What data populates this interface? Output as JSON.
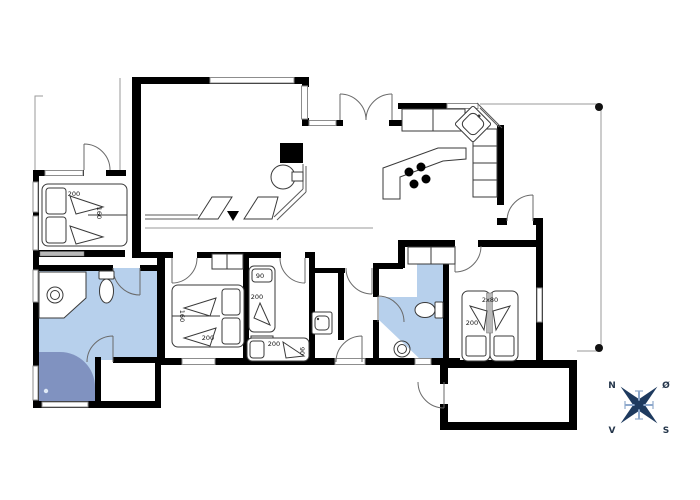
{
  "colors": {
    "wall": "#000000",
    "window_glass": "#8d8d8d",
    "bathroom_floor": "#b7d0ec",
    "shower_floor": "#8092c0",
    "compass_star": "#1e3a5f",
    "compass_cross": "#8fa9cc",
    "terrace_outline": "#9a9a9a"
  },
  "beds": {
    "bedroom_nw": {
      "length": "200",
      "width": "160"
    },
    "bedroom_mid": {
      "width": "160",
      "length": "200"
    },
    "kids_bed_vertical": {
      "width": "90",
      "length": "200"
    },
    "kids_bed_horizontal": {
      "length": "200",
      "width": "90"
    },
    "bedroom_se": {
      "size": "2x80",
      "length": "200"
    }
  },
  "compass": {
    "north": "N",
    "east": "Ø",
    "south": "S",
    "west": "V"
  }
}
